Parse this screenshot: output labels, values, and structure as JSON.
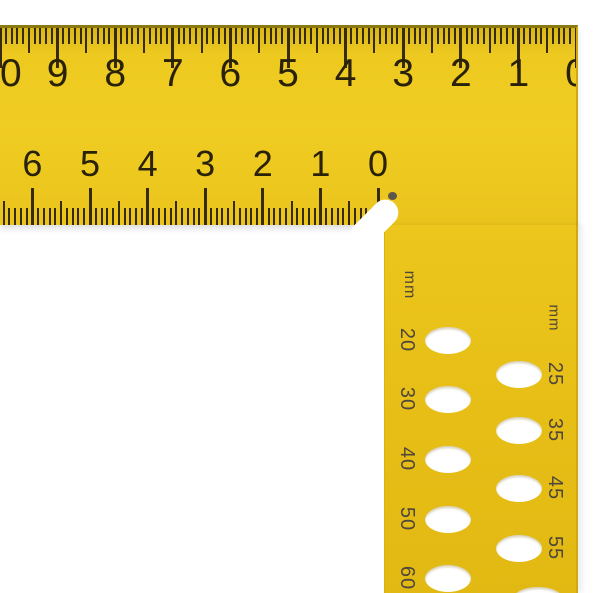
{
  "product": {
    "description": "yellow try square ruler"
  },
  "colors": {
    "body_yellow": "#eac51d",
    "body_yellow_deep": "#e2b912",
    "edge_olive": "#8a7810",
    "tick": "#362c0d",
    "numbers": "#292108",
    "hole_labels": "#4f463c",
    "background": "#ffffff"
  },
  "scales": {
    "top": {
      "labels": [
        "10",
        "9",
        "8",
        "7",
        "6",
        "5",
        "4",
        "3",
        "2",
        "1",
        "0"
      ]
    },
    "inner": {
      "labels": [
        "6",
        "5",
        "4",
        "3",
        "2",
        "1",
        "0"
      ]
    }
  },
  "holes": {
    "left_column": {
      "unit": "mm",
      "labels": [
        "20",
        "30",
        "40",
        "50",
        "60"
      ]
    },
    "right_column": {
      "unit": "mm",
      "labels": [
        "25",
        "35",
        "45",
        "55"
      ]
    }
  }
}
